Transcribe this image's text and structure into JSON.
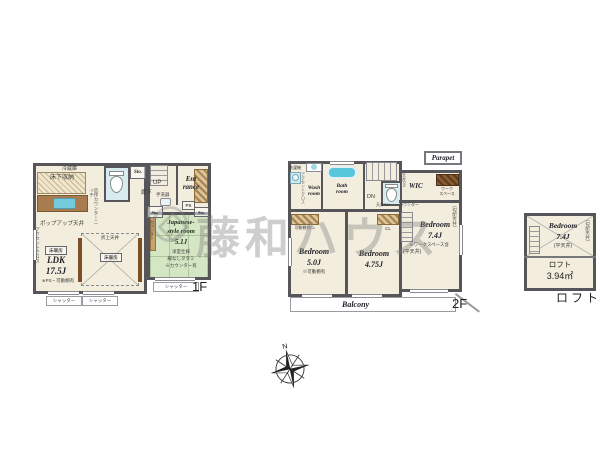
{
  "watermark": {
    "text": "藤和ハウス"
  },
  "compass": {
    "north_label": "N"
  },
  "floor1": {
    "floor_label": "1F",
    "shutter_label": "シャッター",
    "kitchen": {
      "underfloor_storage": "床下収納",
      "refrigerator": "冷蔵庫",
      "counter_niche": "造作カウンターニッチ"
    },
    "ldk": {
      "name": "LDK",
      "size": "17.5J",
      "note": "※PS・可動棚有",
      "popup_ceiling": "ポップアップ天井",
      "accent_cloth": "アクセントクロス",
      "floor_heating": "床暖房",
      "coffered_ceiling": "折上天井"
    },
    "hall": {
      "stairs_up": "UP",
      "hallway": "廊下",
      "hand_basin": "手洗器",
      "storage": "Sto.",
      "pipe_space": "PS"
    },
    "entrance": {
      "line1": "Ent",
      "line2": "rance"
    },
    "japanese_room": {
      "name_line1": "Japanese-",
      "name_line2": "style room",
      "size": "5.1J",
      "spec": "洋室仕様",
      "tatami": "縁なしタタミ",
      "note": "※カウンター有",
      "counter": "カウンター"
    }
  },
  "floor2": {
    "floor_label": "2F",
    "wash_room": {
      "name_line1": "Wash",
      "name_line2": "room",
      "washer": "洗濯機",
      "accent_cloth": "アクセントクロス"
    },
    "bath_room": {
      "name_line1": "Bath",
      "name_line2": "room"
    },
    "hall": {
      "stairs_down": "DN",
      "ceiling_dn": "天井DN",
      "counter": "カウンター"
    },
    "wic": {
      "name": "WIC",
      "ceiling_dn": "天井DN",
      "workspace_line1": "ワーク",
      "workspace_line2": "スペース"
    },
    "parapet": "Parapet",
    "bedroom_74": {
      "name": "Bedroom",
      "size": "7.4J",
      "note": "※ワークスペース含",
      "flat_ceiling": "(平天井)",
      "sloped_ceiling": "(勾配天井)"
    },
    "bedroom_50": {
      "name": "Bedroom",
      "size": "5.0J",
      "note": "※可動棚有",
      "closet": "可動棚付CL"
    },
    "bedroom_475": {
      "name": "Bedroom",
      "size": "4.75J",
      "closet": "CL"
    },
    "balcony": "Balcony"
  },
  "loft": {
    "section_label": "ロフト",
    "bedroom": {
      "name": "Bedroom",
      "size": "7.4J",
      "flat_ceiling": "(平天井)",
      "sloped_ceiling": "(勾配天井)"
    },
    "loft_area": {
      "name": "ロフト",
      "size": "3.94㎡"
    }
  },
  "colors": {
    "wall": "#55555a",
    "floor": "#f3eddd",
    "tatami": "#d5e6c4",
    "water_room": "#d8ecef",
    "bathtub": "#58c6db",
    "wood": "#a87c4f"
  }
}
